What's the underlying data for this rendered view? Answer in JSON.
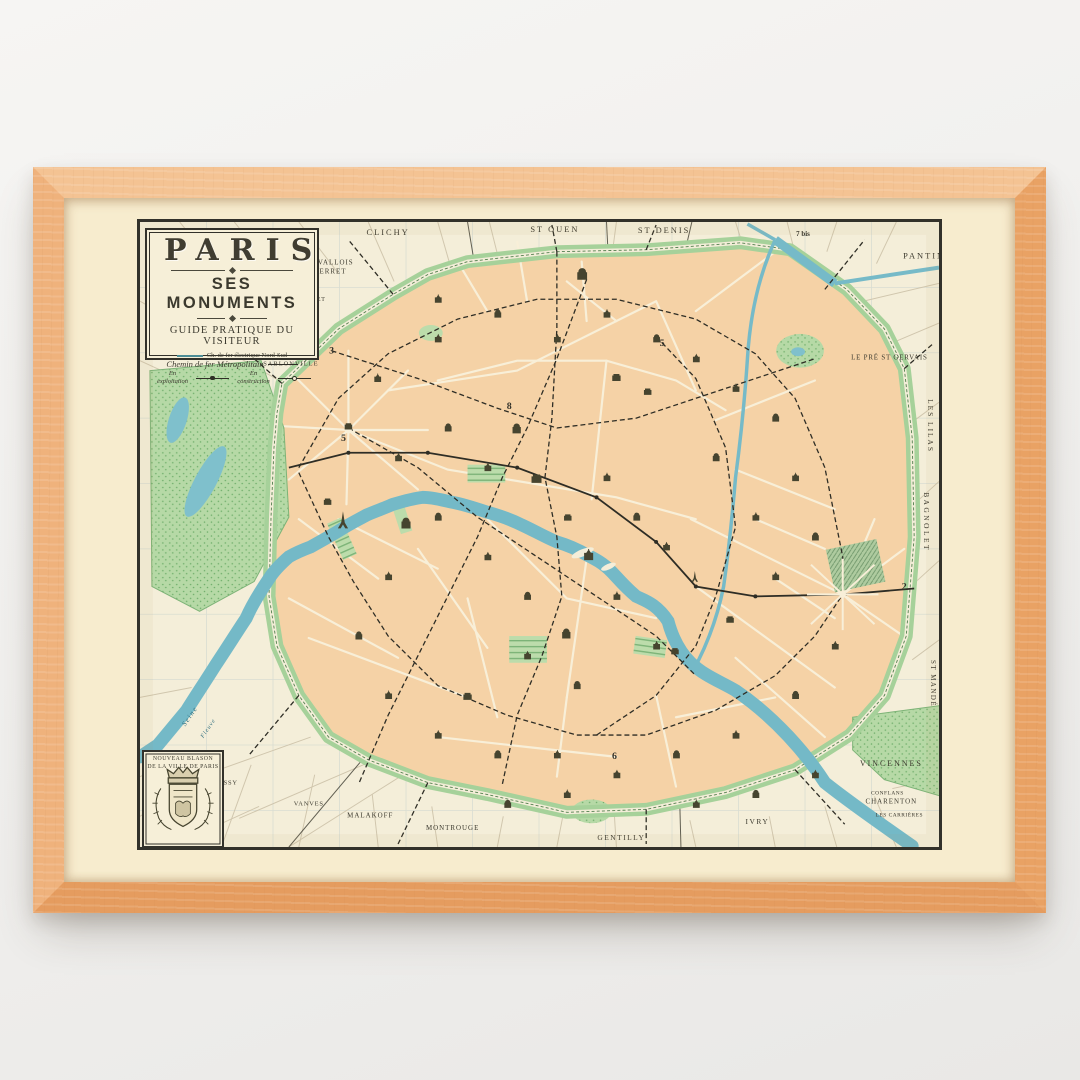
{
  "poster": {
    "title": "PARIS",
    "subtitle": "SES MONUMENTS",
    "tagline": "GUIDE PRATIQUE DU VISITEUR",
    "legend": {
      "nord_sud": "Ch. de fer électrique Nord-Sud",
      "metropolitain": "Chemin de fer Métropolitain",
      "en_exploitation": "En exploitation",
      "en_construction": "En construction"
    },
    "crest": {
      "line1": "NOUVEAU BLASON",
      "line2": "DE LA VILLE DE PARIS"
    },
    "colors": {
      "frame_wood": "#edb07a",
      "mat": "#f7ecce",
      "paper": "#f4eed9",
      "city_blocks": "#f5d2a6",
      "parks": "#a8d29c",
      "water": "#76bac8",
      "ink": "#35342b"
    },
    "labels": {
      "clichy": "CLICHY",
      "st_ouen": "ST OUEN",
      "st_denis": "ST DENIS",
      "pantin": "PANTIN",
      "levallois1": "LEVALLOIS",
      "levallois2": "PERRET",
      "champerret": "CHAMPERRET",
      "sablonville": "SABLONVILLE",
      "pre_st_gervais": "LE PRÉ ST GERVAIS",
      "les_lilas": "LES LILAS",
      "bagnolet": "BAGNOLET",
      "st_mande": "ST MANDÉ",
      "vincennes": "VINCENNES",
      "conflans": "CONFLANS",
      "charenton": "CHARENTON",
      "les_carrieres": "LES CARRIÈRES",
      "ivry": "IVRY",
      "gentilly": "GENTILLY",
      "montrouge": "MONTROUGE",
      "malakoff": "MALAKOFF",
      "vanves": "VANVES",
      "issy": "ISSY",
      "seine": "Seine",
      "fleuve": "Fleuve"
    },
    "numbers": {
      "n3": "3",
      "n5": "5",
      "n8": "8",
      "n5b": "5",
      "n6": "6",
      "n2": "2",
      "n7bis": "7 bis"
    }
  }
}
